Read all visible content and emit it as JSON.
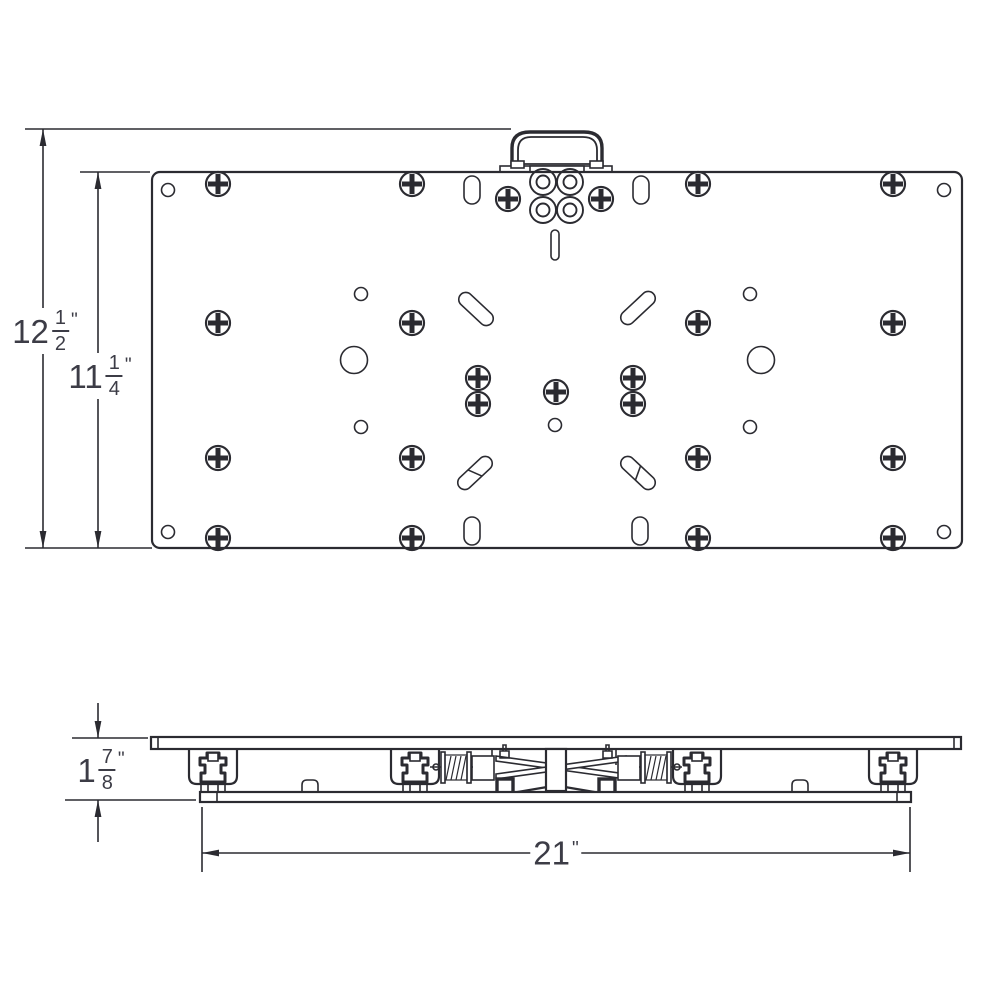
{
  "meta": {
    "description": "Two-view engineering dimension drawing of a quick-release mounting plate with carry handle, track clamps and spring mechanism",
    "views": [
      "top view",
      "side view"
    ]
  },
  "colors": {
    "line": "#2b2b31",
    "text": "#3c3c46",
    "background": "#ffffff"
  },
  "dimensions": {
    "overall_height": {
      "whole": "12",
      "num": "1",
      "den": "2",
      "unit": "\""
    },
    "plate_height": {
      "whole": "11",
      "num": "1",
      "den": "4",
      "unit": "\""
    },
    "side_thickness": {
      "whole": "1",
      "num": "7",
      "den": "8",
      "unit": "\""
    },
    "overall_width": {
      "whole": "21",
      "unit": "\""
    }
  },
  "top_view": {
    "screws": [
      [
        218,
        184
      ],
      [
        412,
        184
      ],
      [
        698,
        184
      ],
      [
        893,
        184
      ],
      [
        508,
        199
      ],
      [
        601,
        199
      ],
      [
        218,
        323
      ],
      [
        412,
        323
      ],
      [
        698,
        323
      ],
      [
        893,
        323
      ],
      [
        478,
        378
      ],
      [
        633,
        378
      ],
      [
        556,
        392
      ],
      [
        478,
        404
      ],
      [
        633,
        404
      ],
      [
        218,
        458
      ],
      [
        412,
        458
      ],
      [
        698,
        458
      ],
      [
        893,
        458
      ],
      [
        218,
        538
      ],
      [
        412,
        538
      ],
      [
        698,
        538
      ],
      [
        893,
        538
      ]
    ],
    "small_holes": [
      [
        168,
        190
      ],
      [
        944,
        190
      ],
      [
        168,
        532
      ],
      [
        944,
        532
      ],
      [
        361,
        294
      ],
      [
        750,
        294
      ],
      [
        361,
        427
      ],
      [
        750,
        427
      ],
      [
        555,
        425
      ]
    ],
    "large_holes": [
      [
        354,
        360
      ],
      [
        761,
        360
      ]
    ],
    "rings": [
      [
        543,
        182
      ],
      [
        570,
        182
      ],
      [
        543,
        210
      ],
      [
        570,
        210
      ]
    ],
    "oval_slots": [
      [
        472,
        190
      ],
      [
        641,
        190
      ],
      [
        472,
        531
      ],
      [
        640,
        531
      ]
    ],
    "diagonal_slots": [
      {
        "cx": 476,
        "cy": 309,
        "angle": 43,
        "chord": false
      },
      {
        "cx": 638,
        "cy": 308,
        "angle": -43,
        "chord": false
      },
      {
        "cx": 475,
        "cy": 473,
        "angle": -43,
        "chord": true
      },
      {
        "cx": 638,
        "cy": 473,
        "angle": 43,
        "chord": true
      }
    ],
    "keyway_slot": {
      "cx": 555,
      "cy": 245
    }
  },
  "side_view": {
    "track_clamps": [
      213,
      415,
      697,
      893
    ],
    "stop_bumps": [
      310,
      800
    ]
  }
}
